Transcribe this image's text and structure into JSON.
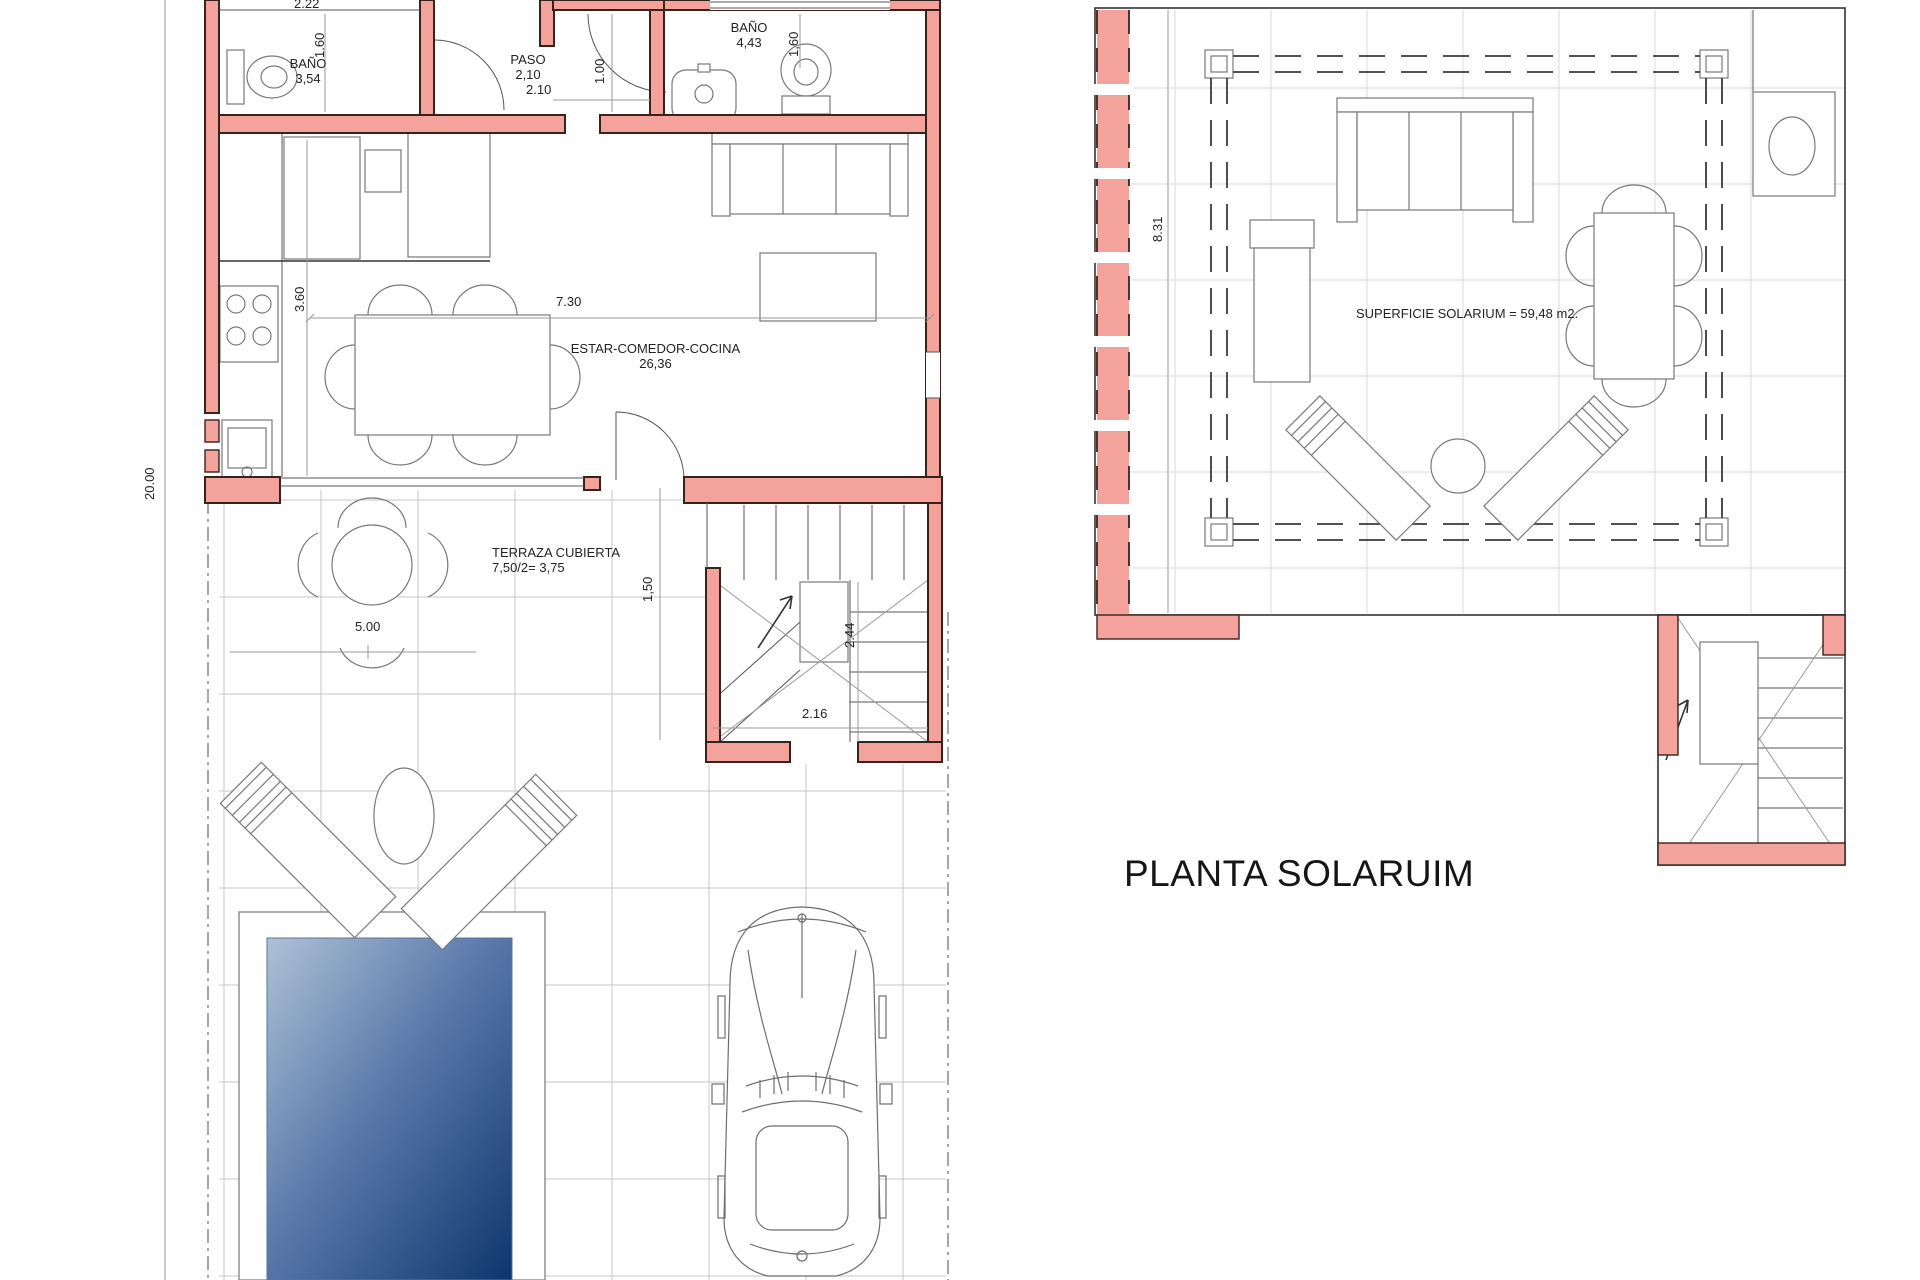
{
  "ground_floor": {
    "rooms": {
      "bath1": {
        "name": "BAÑO",
        "area": "3,54"
      },
      "hall": {
        "name": "PASO",
        "area": "2,10"
      },
      "bath2": {
        "name": "BAÑO",
        "area": "4,43"
      },
      "living": {
        "name": "ESTAR-COMEDOR-COCINA",
        "area": "26,36"
      },
      "terrace": {
        "name": "TERRAZA CUBIERTA",
        "area": "7,50/2= 3,75"
      }
    },
    "dimensions": {
      "bath1_width": "2.22",
      "bath1_depth": "1.60",
      "hall_width": "2.10",
      "hall_depth": "1.00",
      "bath2_depth": "1,60",
      "plot_length": "20.00",
      "kitchen_depth": "3.60",
      "living_width": "7.30",
      "terrace_width": "5.00",
      "terrace_depth": "1,50",
      "stairs_depth": "2.44",
      "stairs_width": "2.16"
    }
  },
  "solarium": {
    "title": "PLANTA SOLARUIM",
    "surface": "SUPERFICIE SOLARIUM = 59,48 m2.",
    "dimensions": {
      "depth": "8.31"
    }
  },
  "colors": {
    "wall": "#F3A39C",
    "wall_outline": "#38231C",
    "pool_light": "#AEC1D6",
    "pool_dark": "#0F356F",
    "grid": "#C7C7C7"
  }
}
